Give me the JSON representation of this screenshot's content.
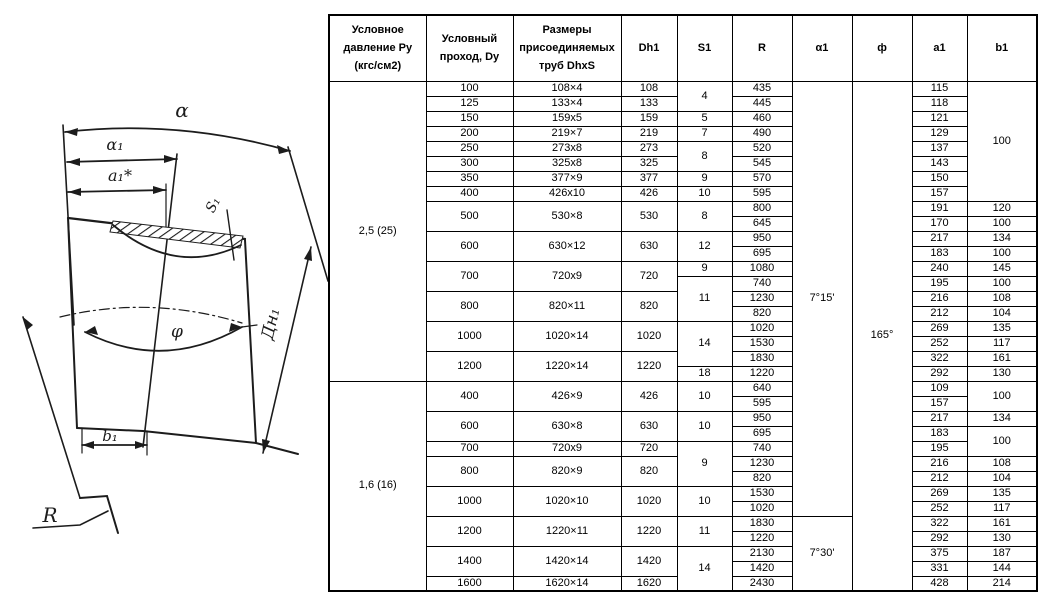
{
  "colors": {
    "line": "#1c1c1c",
    "border": "#000000",
    "background": "#ffffff"
  },
  "drawing": {
    "labels": {
      "alpha": "α",
      "alpha1": "α₁",
      "a1_star": "a₁*",
      "s1": "S₁",
      "dn1": "Дн₁",
      "phi": "φ",
      "b1": "b₁",
      "r": "R"
    }
  },
  "table": {
    "headers": [
      "Условное\nдавление Ру\n(кгс/см2)",
      "Условный\nпроход, Dy",
      "Размеры\nприсоединяемых\nтруб DhxS",
      "Dh1",
      "S1",
      "R",
      "α1",
      "ф",
      "a1",
      "b1"
    ],
    "body_rows": [
      [
        {
          "c": "pressure",
          "v": "2,5 (25)",
          "rs": 20
        },
        {
          "c": "dy",
          "v": "100"
        },
        {
          "c": "dims",
          "v": "108×4"
        },
        {
          "c": "dh1",
          "v": "108"
        },
        {
          "c": "s1",
          "v": "4",
          "rs": 2
        },
        {
          "c": "r",
          "v": "435"
        },
        {
          "c": "alpha1",
          "v": "7°15'",
          "rs": 29
        },
        {
          "c": "phi",
          "v": "165°",
          "rs": 34
        },
        {
          "c": "a1",
          "v": "115"
        },
        {
          "c": "b1",
          "v": "100",
          "rs": 8
        }
      ],
      [
        {
          "c": "dy",
          "v": "125"
        },
        {
          "c": "dims",
          "v": "133×4"
        },
        {
          "c": "dh1",
          "v": "133"
        },
        {
          "c": "r",
          "v": "445"
        },
        {
          "c": "a1",
          "v": "118"
        }
      ],
      [
        {
          "c": "dy",
          "v": "150"
        },
        {
          "c": "dims",
          "v": "159x5"
        },
        {
          "c": "dh1",
          "v": "159"
        },
        {
          "c": "s1",
          "v": "5"
        },
        {
          "c": "r",
          "v": "460"
        },
        {
          "c": "a1",
          "v": "121"
        }
      ],
      [
        {
          "c": "dy",
          "v": "200"
        },
        {
          "c": "dims",
          "v": "219×7"
        },
        {
          "c": "dh1",
          "v": "219"
        },
        {
          "c": "s1",
          "v": "7"
        },
        {
          "c": "r",
          "v": "490"
        },
        {
          "c": "a1",
          "v": "129"
        }
      ],
      [
        {
          "c": "dy",
          "v": "250"
        },
        {
          "c": "dims",
          "v": "273x8"
        },
        {
          "c": "dh1",
          "v": "273"
        },
        {
          "c": "s1",
          "v": "8",
          "rs": 2
        },
        {
          "c": "r",
          "v": "520"
        },
        {
          "c": "a1",
          "v": "137"
        }
      ],
      [
        {
          "c": "dy",
          "v": "300"
        },
        {
          "c": "dims",
          "v": "325x8"
        },
        {
          "c": "dh1",
          "v": "325"
        },
        {
          "c": "r",
          "v": "545"
        },
        {
          "c": "a1",
          "v": "143"
        }
      ],
      [
        {
          "c": "dy",
          "v": "350"
        },
        {
          "c": "dims",
          "v": "377×9"
        },
        {
          "c": "dh1",
          "v": "377"
        },
        {
          "c": "s1",
          "v": "9"
        },
        {
          "c": "r",
          "v": "570"
        },
        {
          "c": "a1",
          "v": "150"
        }
      ],
      [
        {
          "c": "dy",
          "v": "400"
        },
        {
          "c": "dims",
          "v": "426x10"
        },
        {
          "c": "dh1",
          "v": "426"
        },
        {
          "c": "s1",
          "v": "10"
        },
        {
          "c": "r",
          "v": "595"
        },
        {
          "c": "a1",
          "v": "157"
        }
      ],
      [
        {
          "c": "dy",
          "v": "500",
          "rs": 2
        },
        {
          "c": "dims",
          "v": "530×8",
          "rs": 2
        },
        {
          "c": "dh1",
          "v": "530",
          "rs": 2
        },
        {
          "c": "s1",
          "v": "8",
          "rs": 2
        },
        {
          "c": "r",
          "v": "800"
        },
        {
          "c": "a1",
          "v": "191"
        },
        {
          "c": "b1",
          "v": "120"
        }
      ],
      [
        {
          "c": "r",
          "v": "645"
        },
        {
          "c": "a1",
          "v": "170"
        },
        {
          "c": "b1",
          "v": "100"
        }
      ],
      [
        {
          "c": "dy",
          "v": "600",
          "rs": 2
        },
        {
          "c": "dims",
          "v": "630×12",
          "rs": 2
        },
        {
          "c": "dh1",
          "v": "630",
          "rs": 2
        },
        {
          "c": "s1",
          "v": "12",
          "rs": 2
        },
        {
          "c": "r",
          "v": "950"
        },
        {
          "c": "a1",
          "v": "217"
        },
        {
          "c": "b1",
          "v": "134"
        }
      ],
      [
        {
          "c": "r",
          "v": "695"
        },
        {
          "c": "a1",
          "v": "183"
        },
        {
          "c": "b1",
          "v": "100"
        }
      ],
      [
        {
          "c": "dy",
          "v": "700",
          "rs": 2
        },
        {
          "c": "dims",
          "v": "720x9",
          "rs": 2
        },
        {
          "c": "dh1",
          "v": "720",
          "rs": 2
        },
        {
          "c": "s1",
          "v": "9"
        },
        {
          "c": "r",
          "v": "1080"
        },
        {
          "c": "a1",
          "v": "240"
        },
        {
          "c": "b1",
          "v": "145"
        }
      ],
      [
        {
          "c": "s1",
          "v": "11",
          "rs": 3
        },
        {
          "c": "r",
          "v": "740"
        },
        {
          "c": "a1",
          "v": "195"
        },
        {
          "c": "b1",
          "v": "100"
        }
      ],
      [
        {
          "c": "dy",
          "v": "800",
          "rs": 2
        },
        {
          "c": "dims",
          "v": "820×11",
          "rs": 2
        },
        {
          "c": "dh1",
          "v": "820",
          "rs": 2
        },
        {
          "c": "r",
          "v": "1230"
        },
        {
          "c": "a1",
          "v": "216"
        },
        {
          "c": "b1",
          "v": "108"
        }
      ],
      [
        {
          "c": "r",
          "v": "820"
        },
        {
          "c": "a1",
          "v": "212"
        },
        {
          "c": "b1",
          "v": "104"
        }
      ],
      [
        {
          "c": "dy",
          "v": "1000",
          "rs": 2
        },
        {
          "c": "dims",
          "v": "1020×14",
          "rs": 2
        },
        {
          "c": "dh1",
          "v": "1020",
          "rs": 2
        },
        {
          "c": "s1",
          "v": "14",
          "rs": 3
        },
        {
          "c": "r",
          "v": "1020"
        },
        {
          "c": "a1",
          "v": "269"
        },
        {
          "c": "b1",
          "v": "135"
        }
      ],
      [
        {
          "c": "r",
          "v": "1530"
        },
        {
          "c": "a1",
          "v": "252"
        },
        {
          "c": "b1",
          "v": "117"
        }
      ],
      [
        {
          "c": "dy",
          "v": "1200",
          "rs": 2
        },
        {
          "c": "dims",
          "v": "1220×14",
          "rs": 2
        },
        {
          "c": "dh1",
          "v": "1220",
          "rs": 2
        },
        {
          "c": "r",
          "v": "1830"
        },
        {
          "c": "a1",
          "v": "322"
        },
        {
          "c": "b1",
          "v": "161"
        }
      ],
      [
        {
          "c": "s1",
          "v": "18"
        },
        {
          "c": "r",
          "v": "1220"
        },
        {
          "c": "a1",
          "v": "292"
        },
        {
          "c": "b1",
          "v": "130"
        }
      ],
      [
        {
          "c": "pressure",
          "v": "1,6 (16)",
          "rs": 14
        },
        {
          "c": "dy",
          "v": "400",
          "rs": 2
        },
        {
          "c": "dims",
          "v": "426×9",
          "rs": 2
        },
        {
          "c": "dh1",
          "v": "426",
          "rs": 2
        },
        {
          "c": "s1",
          "v": "10",
          "rs": 2
        },
        {
          "c": "r",
          "v": "640"
        },
        {
          "c": "a1",
          "v": "109"
        },
        {
          "c": "b1",
          "v": "100",
          "rs": 2
        }
      ],
      [
        {
          "c": "r",
          "v": "595"
        },
        {
          "c": "a1",
          "v": "157"
        }
      ],
      [
        {
          "c": "dy",
          "v": "600",
          "rs": 2
        },
        {
          "c": "dims",
          "v": "630×8",
          "rs": 2
        },
        {
          "c": "dh1",
          "v": "630",
          "rs": 2
        },
        {
          "c": "s1",
          "v": "10",
          "rs": 2
        },
        {
          "c": "r",
          "v": "950"
        },
        {
          "c": "a1",
          "v": "217"
        },
        {
          "c": "b1",
          "v": "134"
        }
      ],
      [
        {
          "c": "r",
          "v": "695"
        },
        {
          "c": "a1",
          "v": "183"
        },
        {
          "c": "b1",
          "v": "100",
          "rs": 2
        }
      ],
      [
        {
          "c": "dy",
          "v": "700"
        },
        {
          "c": "dims",
          "v": "720x9"
        },
        {
          "c": "dh1",
          "v": "720"
        },
        {
          "c": "s1",
          "v": "9",
          "rs": 3
        },
        {
          "c": "r",
          "v": "740"
        },
        {
          "c": "a1",
          "v": "195"
        }
      ],
      [
        {
          "c": "dy",
          "v": "800",
          "rs": 2
        },
        {
          "c": "dims",
          "v": "820×9",
          "rs": 2
        },
        {
          "c": "dh1",
          "v": "820",
          "rs": 2
        },
        {
          "c": "r",
          "v": "1230"
        },
        {
          "c": "a1",
          "v": "216"
        },
        {
          "c": "b1",
          "v": "108"
        }
      ],
      [
        {
          "c": "r",
          "v": "820"
        },
        {
          "c": "a1",
          "v": "212"
        },
        {
          "c": "b1",
          "v": "104"
        }
      ],
      [
        {
          "c": "dy",
          "v": "1000",
          "rs": 2
        },
        {
          "c": "dims",
          "v": "1020×10",
          "rs": 2
        },
        {
          "c": "dh1",
          "v": "1020",
          "rs": 2
        },
        {
          "c": "s1",
          "v": "10",
          "rs": 2
        },
        {
          "c": "r",
          "v": "1530"
        },
        {
          "c": "a1",
          "v": "269"
        },
        {
          "c": "b1",
          "v": "135"
        }
      ],
      [
        {
          "c": "r",
          "v": "1020"
        },
        {
          "c": "a1",
          "v": "252"
        },
        {
          "c": "b1",
          "v": "117"
        }
      ],
      [
        {
          "c": "dy",
          "v": "1200",
          "rs": 2
        },
        {
          "c": "dims",
          "v": "1220×11",
          "rs": 2
        },
        {
          "c": "dh1",
          "v": "1220",
          "rs": 2
        },
        {
          "c": "s1",
          "v": "11",
          "rs": 2
        },
        {
          "c": "r",
          "v": "1830"
        },
        {
          "c": "alpha1",
          "v": "7°30'",
          "rs": 5
        },
        {
          "c": "a1",
          "v": "322"
        },
        {
          "c": "b1",
          "v": "161"
        }
      ],
      [
        {
          "c": "r",
          "v": "1220"
        },
        {
          "c": "a1",
          "v": "292"
        },
        {
          "c": "b1",
          "v": "130"
        }
      ],
      [
        {
          "c": "dy",
          "v": "1400",
          "rs": 2
        },
        {
          "c": "dims",
          "v": "1420×14",
          "rs": 2
        },
        {
          "c": "dh1",
          "v": "1420",
          "rs": 2
        },
        {
          "c": "s1",
          "v": "14",
          "rs": 3
        },
        {
          "c": "r",
          "v": "2130"
        },
        {
          "c": "a1",
          "v": "375"
        },
        {
          "c": "b1",
          "v": "187"
        }
      ],
      [
        {
          "c": "r",
          "v": "1420"
        },
        {
          "c": "a1",
          "v": "331"
        },
        {
          "c": "b1",
          "v": "144"
        }
      ],
      [
        {
          "c": "dy",
          "v": "1600"
        },
        {
          "c": "dims",
          "v": "1620×14"
        },
        {
          "c": "dh1",
          "v": "1620"
        },
        {
          "c": "r",
          "v": "2430"
        },
        {
          "c": "a1",
          "v": "428"
        },
        {
          "c": "b1",
          "v": "214"
        }
      ]
    ]
  }
}
